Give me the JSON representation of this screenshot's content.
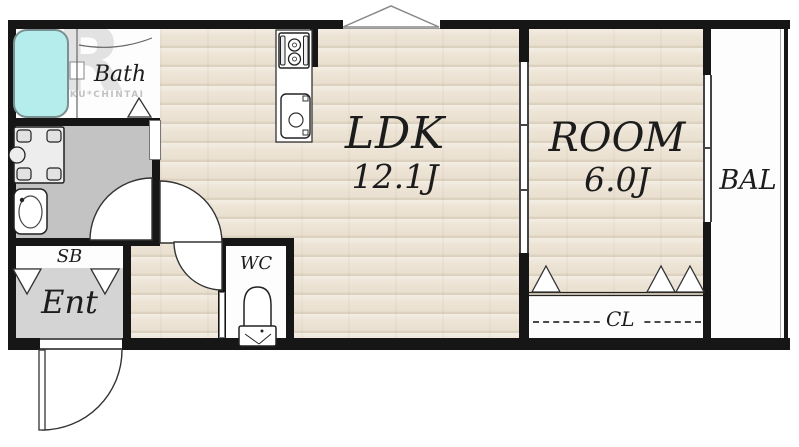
{
  "watermark": {
    "logo": "R",
    "text": "RAKURAKU*CHINTAI"
  },
  "rooms": {
    "ldk": {
      "label": "LDK",
      "size": "12.1J"
    },
    "room": {
      "label": "ROOM",
      "size": "6.0J"
    },
    "bath": {
      "label": "Bath"
    },
    "balcony": {
      "label": "BAL"
    },
    "entrance": {
      "label": "Ent"
    },
    "shoe_box": {
      "label": "SB"
    },
    "toilet": {
      "label": "WC"
    },
    "closet": {
      "label": "CL"
    }
  },
  "fixtures": [
    "bathtub",
    "washing-machine-pan",
    "wash-basin",
    "toilet",
    "gas-stove",
    "kitchen-sink",
    "entrance-door",
    "door-swings",
    "folding-doors",
    "sliding-door",
    "balcony-window"
  ],
  "colors": {
    "wall": "#161616",
    "wood_floor": "#ece3d6",
    "washroom_floor": "#c3c3c3",
    "entrance_floor": "#d4d4d4",
    "bathtub_fill": "#b5ecec",
    "watermark_gray": "#c2c2c2"
  }
}
